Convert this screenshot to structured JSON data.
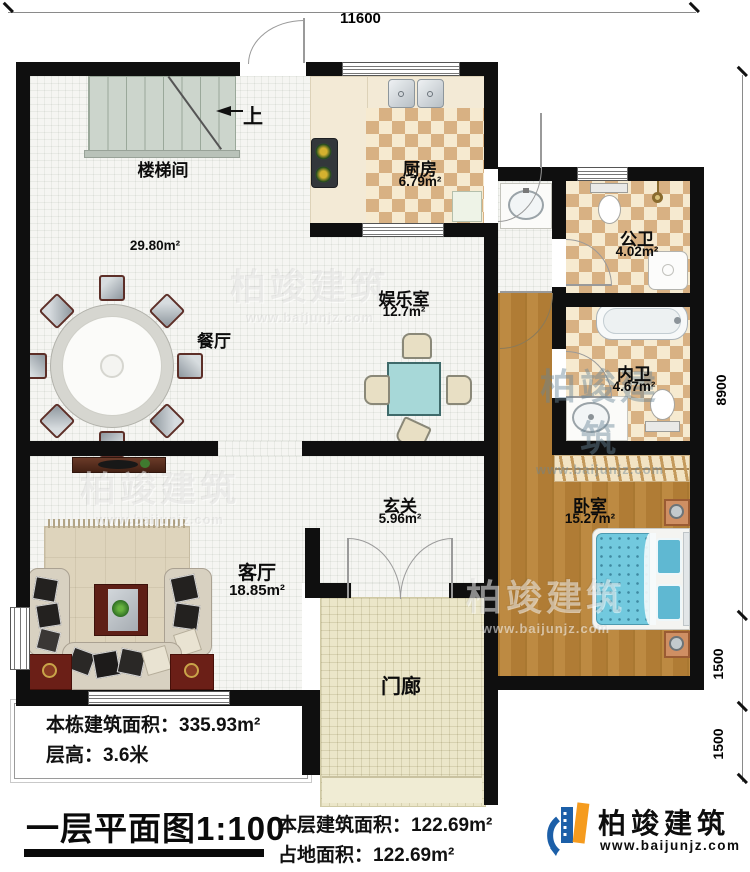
{
  "dimensions": {
    "top": "11600",
    "right": [
      "8900",
      "1500",
      "1500"
    ]
  },
  "rooms": {
    "stairwell": {
      "name": "楼梯间"
    },
    "kitchen": {
      "name": "厨房",
      "area": "6.79m²"
    },
    "public_bathسsentinel": null,
    "public_bath": {
      "name": "公卫",
      "area": "4.02m²"
    },
    "inner_bath": {
      "name": "内卫",
      "area": "4.67m²"
    },
    "game_room": {
      "name": "娱乐室",
      "area": "12.7m²"
    },
    "dining": {
      "name": "餐厅"
    },
    "foyer": {
      "name": "玄关",
      "area": "5.96m²"
    },
    "bedroom": {
      "name": "卧室",
      "area": "15.27m²"
    },
    "living": {
      "name": "客厅",
      "area": "18.85m²"
    },
    "porch": {
      "name": "门廊"
    }
  },
  "annotations": {
    "hall_area": "29.80m²",
    "stairs_up": "上"
  },
  "notes": {
    "building_area": "本栋建筑面积：335.93m²",
    "floor_height": "层高：3.6米"
  },
  "title_block": {
    "plan_title": "一层平面图1:100",
    "floor_area": "本层建筑面积：122.69m²",
    "footprint": "占地面积：122.69m²"
  },
  "logo": {
    "name": "柏竣建筑",
    "website": "www.baijunjz.com"
  },
  "watermark": {
    "text": "柏竣建筑",
    "url": "www.baijunjz.com"
  },
  "colors": {
    "wall": "#0f0f0f",
    "checker": "#d8b183",
    "wood": "#b9853e",
    "bed": "#72c9de",
    "logo_blue": "#1c5fa8",
    "logo_orange": "#f59b1e"
  }
}
